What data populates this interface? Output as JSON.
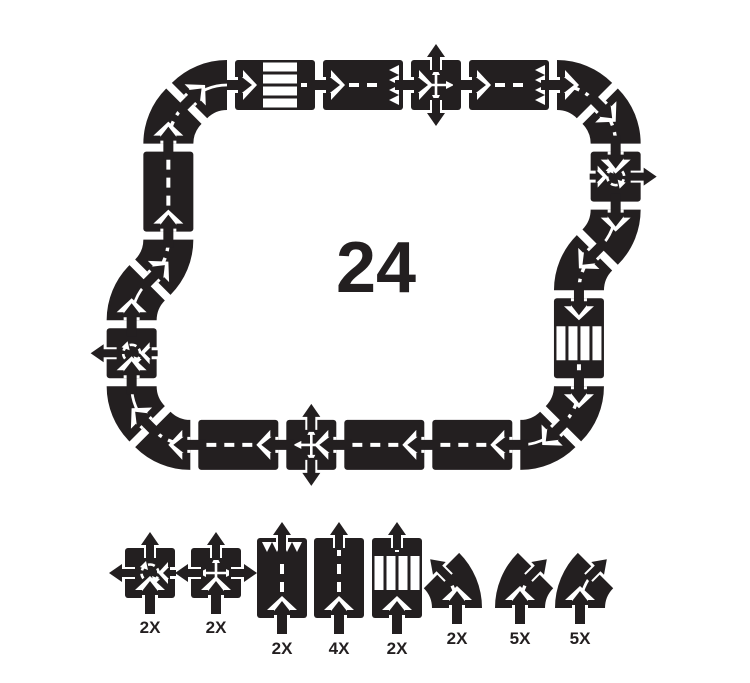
{
  "product": {
    "piece_count": "24"
  },
  "colors": {
    "road": "#231f20",
    "marking": "#ffffff",
    "background": "#ffffff"
  },
  "track": {
    "start": {
      "x": 235,
      "y": 85,
      "heading": 0
    },
    "sequence": [
      "crosswalk",
      "deadend",
      "crossroads",
      "deadend",
      "curve-r",
      "curve-r",
      "roundabout",
      "curve-r-solid",
      "curve-l",
      "crosswalk",
      "curve-r",
      "curve-r-solid",
      "straight",
      "straight",
      "crossroads",
      "straight",
      "curve-r",
      "curve-r-solid",
      "roundabout",
      "curve-r-solid",
      "curve-l",
      "straight",
      "curve-r",
      "curve-r-solid"
    ]
  },
  "legend": {
    "items": [
      {
        "piece": "roundabout",
        "count": "2X"
      },
      {
        "piece": "crossroads",
        "count": "2X"
      },
      {
        "piece": "deadend-straight",
        "count": "2X"
      },
      {
        "piece": "straight",
        "count": "4X"
      },
      {
        "piece": "crosswalk-straight",
        "count": "2X"
      },
      {
        "piece": "curve-left",
        "count": "2X"
      },
      {
        "piece": "curve-right",
        "count": "5X"
      },
      {
        "piece": "curve-right-solid",
        "count": "5X"
      }
    ]
  }
}
